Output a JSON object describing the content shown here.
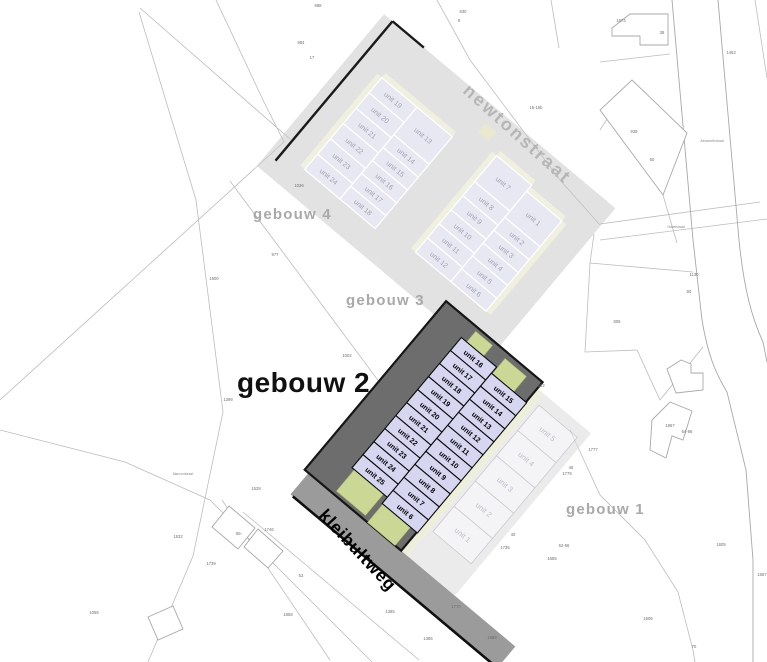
{
  "map": {
    "title": "site plan kleibultweg / newtonstraat",
    "streets": {
      "newtonstraat": "newtonstraat",
      "kleibultweg": "kleibultweg",
      "minor": [
        {
          "label": "Ainsworthstraat",
          "x": 712,
          "y": 139
        },
        {
          "label": "Nobelstraat",
          "x": 676,
          "y": 225
        },
        {
          "label": "Marconistraat",
          "x": 183,
          "y": 472
        }
      ]
    },
    "buildings": {
      "gebouw1": {
        "label": "gebouw 1",
        "units": [
          "unit 5",
          "unit 4",
          "unit 3",
          "unit 2",
          "unit 1"
        ]
      },
      "gebouw2": {
        "label": "gebouw 2",
        "left_units": [
          "unit 16",
          "unit 17",
          "unit 18",
          "unit 19",
          "unit 20",
          "unit 21",
          "unit 22",
          "unit 23",
          "unit 24",
          "unit 25"
        ],
        "right_units": [
          "unit 15",
          "unit 14",
          "unit 13",
          "unit 12",
          "unit 11",
          "unit 10",
          "unit 9",
          "unit 8",
          "unit 7",
          "unit 6"
        ]
      },
      "gebouw3": {
        "label": "gebouw 3",
        "left_units": [
          "unit 7",
          "unit 8",
          "unit 9",
          "unit 10",
          "unit 11",
          "unit 12"
        ],
        "right_units": [
          "unit 1",
          "unit 2",
          "unit 3",
          "unit 4",
          "unit 5",
          "unit 6"
        ]
      },
      "gebouw4": {
        "label": "gebouw 4",
        "left_units": [
          "unit 19",
          "unit 20",
          "unit 21",
          "unit 22",
          "unit 23",
          "unit 24"
        ],
        "right_units": [
          "unit 13",
          "unit 14",
          "unit 15",
          "unit 16",
          "unit 17",
          "unit 18"
        ]
      }
    },
    "parcel_numbers": [
      {
        "t": "888",
        "x": 318,
        "y": 4
      },
      {
        "t": "884",
        "x": 301,
        "y": 41
      },
      {
        "t": "17",
        "x": 312,
        "y": 56
      },
      {
        "t": "830",
        "x": 463,
        "y": 10
      },
      {
        "t": "9",
        "x": 459,
        "y": 19
      },
      {
        "t": "1574",
        "x": 621,
        "y": 19
      },
      {
        "t": "38",
        "x": 662,
        "y": 31
      },
      {
        "t": "1463",
        "x": 731,
        "y": 51
      },
      {
        "t": "15-15b",
        "x": 536,
        "y": 106
      },
      {
        "t": "939",
        "x": 634,
        "y": 130
      },
      {
        "t": "50",
        "x": 652,
        "y": 158
      },
      {
        "t": "1026",
        "x": 299,
        "y": 184
      },
      {
        "t": "977",
        "x": 275,
        "y": 253
      },
      {
        "t": "1900",
        "x": 214,
        "y": 277
      },
      {
        "t": "1130",
        "x": 694,
        "y": 273
      },
      {
        "t": "60",
        "x": 689,
        "y": 290
      },
      {
        "t": "806",
        "x": 617,
        "y": 320
      },
      {
        "t": "1002",
        "x": 347,
        "y": 354
      },
      {
        "t": "1862",
        "x": 540,
        "y": 384
      },
      {
        "t": "1399",
        "x": 228,
        "y": 398
      },
      {
        "t": "1867",
        "x": 670,
        "y": 424
      },
      {
        "t": "64-66",
        "x": 687,
        "y": 430
      },
      {
        "t": "1777",
        "x": 593,
        "y": 448
      },
      {
        "t": "46",
        "x": 571,
        "y": 466
      },
      {
        "t": "1779",
        "x": 567,
        "y": 472
      },
      {
        "t": "1528",
        "x": 256,
        "y": 487
      },
      {
        "t": "40",
        "x": 513,
        "y": 533
      },
      {
        "t": "1735",
        "x": 505,
        "y": 546
      },
      {
        "t": "52-56",
        "x": 564,
        "y": 544
      },
      {
        "t": "1685",
        "x": 552,
        "y": 557
      },
      {
        "t": "1605",
        "x": 721,
        "y": 543
      },
      {
        "t": "1667",
        "x": 762,
        "y": 573
      },
      {
        "t": "55-",
        "x": 239,
        "y": 532
      },
      {
        "t": "1746",
        "x": 269,
        "y": 528
      },
      {
        "t": "1532",
        "x": 178,
        "y": 535
      },
      {
        "t": "1739",
        "x": 211,
        "y": 562
      },
      {
        "t": "53",
        "x": 301,
        "y": 574
      },
      {
        "t": "1858",
        "x": 288,
        "y": 613
      },
      {
        "t": "1385",
        "x": 390,
        "y": 610
      },
      {
        "t": "1770",
        "x": 456,
        "y": 605
      },
      {
        "t": "1386",
        "x": 428,
        "y": 637
      },
      {
        "t": "1689",
        "x": 492,
        "y": 636
      },
      {
        "t": "1606",
        "x": 648,
        "y": 617
      },
      {
        "t": "70",
        "x": 694,
        "y": 645
      },
      {
        "t": "1058",
        "x": 94,
        "y": 611
      }
    ],
    "colors": {
      "unit_fill_highlight": "#d6d6f1",
      "unit_fill_faded": "#e8e8f3",
      "dark_parcel": "#6d6d6d",
      "green_patch": "#cbd795",
      "pale_strip": "#eef0d8",
      "road_gray": "#e2e2e2",
      "label_gray": "#a9a9a9"
    }
  }
}
